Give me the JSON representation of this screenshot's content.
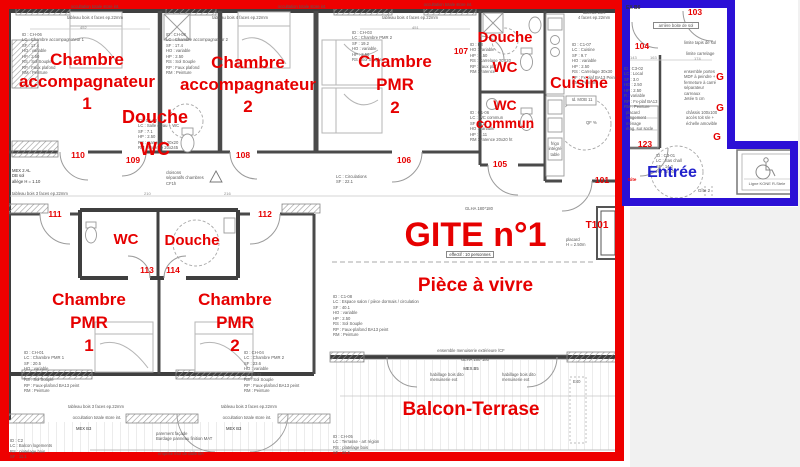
{
  "document_type": "architectural floor plan",
  "colors": {
    "gite_outline_red": "#ee0000",
    "annotation_red": "#e60000",
    "entree_outline_blue": "#2b10d6",
    "entree_text_blue": "#2222cc",
    "wall_dark": "#3f3f3f",
    "drawing_gray": "#999999",
    "background_outside": "#f1f1f1"
  },
  "title": {
    "main": "GITE n°1",
    "effectif": "effectif : 10 personnes",
    "living_room": "Pièce à vivre",
    "balcony": "Balcon-Terrase",
    "entrance": "Entrée"
  },
  "rooms": {
    "accomp1": [
      "Chambre",
      "accompagnateur",
      "1"
    ],
    "accomp2": [
      "Chambre",
      "accompagnateur",
      "2"
    ],
    "douche109": [
      "Douche",
      "WC"
    ],
    "pmr2_haut": [
      "Chambre",
      "PMR",
      "2"
    ],
    "douche107": [
      "Douche",
      "WC"
    ],
    "wc_commun": [
      "WC",
      "commun"
    ],
    "cuisine": [
      "Cuisine"
    ],
    "wc113": [
      "WC"
    ],
    "douche114": [
      "Douche"
    ],
    "pmr1": [
      "Chambre",
      "PMR",
      "1"
    ],
    "pmr2_bas": [
      "Chambre",
      "PMR",
      "2"
    ]
  },
  "door_numbers": {
    "n110": "110",
    "n109": "109",
    "n108": "108",
    "n107": "107",
    "n106": "106",
    "n105": "105",
    "n101": "101",
    "n103": "103",
    "n104": "104",
    "n123": "123",
    "n111": "111",
    "n112": "112",
    "n113": "113",
    "n114": "114",
    "t101": "T101",
    "g": "G",
    "gite_mark": "Gite",
    "gite2": "Gîte 2"
  },
  "tiny": {
    "occultation": "occultation totale store int.",
    "tableau4": "tableau bois 4 faces ep.22mm",
    "tableau4_2l": [
      "tableau bois",
      "4 faces ep.22mm"
    ],
    "tableau3": "tableau bois 3 faces ep.22mm",
    "mex2al": [
      "MEX 2 AL",
      "DB sol",
      "allège H = 1.10"
    ],
    "cloisons": [
      "cloisons",
      "séparatifs chambres",
      "CF1h"
    ],
    "circulations": [
      "LC : Circulations",
      "SF : 22.1"
    ],
    "mexb3": "MEX B3",
    "mexb5": "MEX.B5",
    "glha": "GLHA 180*180",
    "ensemble_men": "ensemble menuiserie extérieure /CF",
    "parement": [
      "parement façade",
      "Bardage panneau finition MAT"
    ],
    "emprise": "emprise mur de dalle BA",
    "habillage": [
      "habillage bois dito",
      "menuiserie ext"
    ],
    "e40": "E40",
    "exb6": "EX B6",
    "arriere": "arrière boite de sol",
    "limite_tapis": "limite tapis de sol",
    "limite_carrelage": "limite carrelage",
    "ensemble_portes": [
      "ensemble portes",
      "MDF à peindre +",
      "fermeture à carré",
      "séparateur carreaux",
      "Jetée 5 cm"
    ],
    "chassis": [
      "châssis 100x100",
      "accès toit s/e +",
      "échelle amovible"
    ],
    "kone": "Ligne KONE R-Stele",
    "placard_t101": [
      "placard",
      "H = 2.50m"
    ],
    "idmob": "Id. MOB 11",
    "qf": "QF %",
    "frigo": [
      "frigo",
      "intégré",
      "table"
    ],
    "closet123": [
      "placard rangement",
      "ménage",
      "étag. sur socle"
    ]
  },
  "specs": {
    "accomp1": [
      "ID : CH-06",
      "LC : Chambre accompagnateur 1",
      "SF : 17.4",
      "HO : variable",
      "HP : 2.50",
      "RS : Sol Souple",
      "RP : Faux plafond",
      "RM : Peinture"
    ],
    "accomp2": [
      "ID : CH-08",
      "LC : Chambre accompagnateur 2",
      "SF : 17.4",
      "HO : variable",
      "HP : 2.50",
      "RS : Sol Souple",
      "RP : Faux plafond",
      "RM : Peinture"
    ],
    "pmr2_haut": [
      "ID : CH-03",
      "LC : Chambre PMR 2",
      "SF : 19.2",
      "HO : variable",
      "HP : 2.50",
      "RS : Sol Souple"
    ],
    "douche109": [
      "ID : C1-02",
      "LC : Salle d'eau + WC",
      "SF : 7.1",
      "HP : 2.50",
      "RS : Carrelage 20x20",
      "RM : Faïence 20x245"
    ],
    "douche107": [
      "ID : K3",
      "HO : variable",
      "HP : 2.50",
      "RS : Carrelage 20X20",
      "RP : Faux plaf.",
      "RM : Faïence"
    ],
    "wc_commun": [
      "ID : C1-06",
      "LC : WC commun",
      "SF : 3.1",
      "HO : variable",
      "HP : 2.11",
      "RM : Faïence 20x20 ht"
    ],
    "cuisine": [
      "ID : C1-07",
      "LC : Cuisine",
      "SF : 9.7",
      "HO : variable",
      "HP : 2.50",
      "RS : Carrelage 30x30",
      "RF : Fx-plaf BA13 Peint",
      "RM : Peinture"
    ],
    "pmr1": [
      "ID : CH-01",
      "LC : Chambre PMR 1",
      "SF : 20.5",
      "HO : variable",
      "HP : 2.50",
      "RS : Sol Souple",
      "RP : Faux-plafond BA13 peint",
      "RM : Peinture"
    ],
    "pmr2_bas": [
      "ID : CH-04",
      "LC : Chambre PMR 2",
      "SF : 23.6",
      "HO : variable",
      "HP : 2.33",
      "RS : Sol Souple",
      "RP : Faux-plafond BA13 peint",
      "RM : Peinture"
    ],
    "sejour": [
      "ID : C1-08",
      "LC : Espace salon / pièce dormais / circulation",
      "SF : 40.1",
      "HO : variable",
      "HP : 2.50",
      "RS : Sol Souple",
      "RP : Faux-plafond BA13 peint",
      "RM : Peinture"
    ],
    "balcon": [
      "ID : CH-05",
      "LC : Terrasse - art région",
      "RS : platelage bois",
      "SF : 26.5"
    ],
    "balcon_gauche": [
      "ID : C2",
      "LC : Balcon logements",
      "RS : platelage bois",
      "SF : 11.1"
    ],
    "sas": [
      "ID : C3-01",
      "LC : Sas chall",
      "SF : 14.2",
      "HO : 2.50"
    ],
    "local": [
      "ID : C3-02",
      "LC : Local",
      "SF : 3.0",
      "HO : 2.50",
      "HP : 2.50",
      "R : variable",
      "RP : Fx-plaf BA13",
      "RM : Peinture"
    ]
  },
  "dims": {
    "d452": "452",
    "d451": "451",
    "d210": "210",
    "d216": "216",
    "d174": "174",
    "d143": "143",
    "d163": "163"
  }
}
